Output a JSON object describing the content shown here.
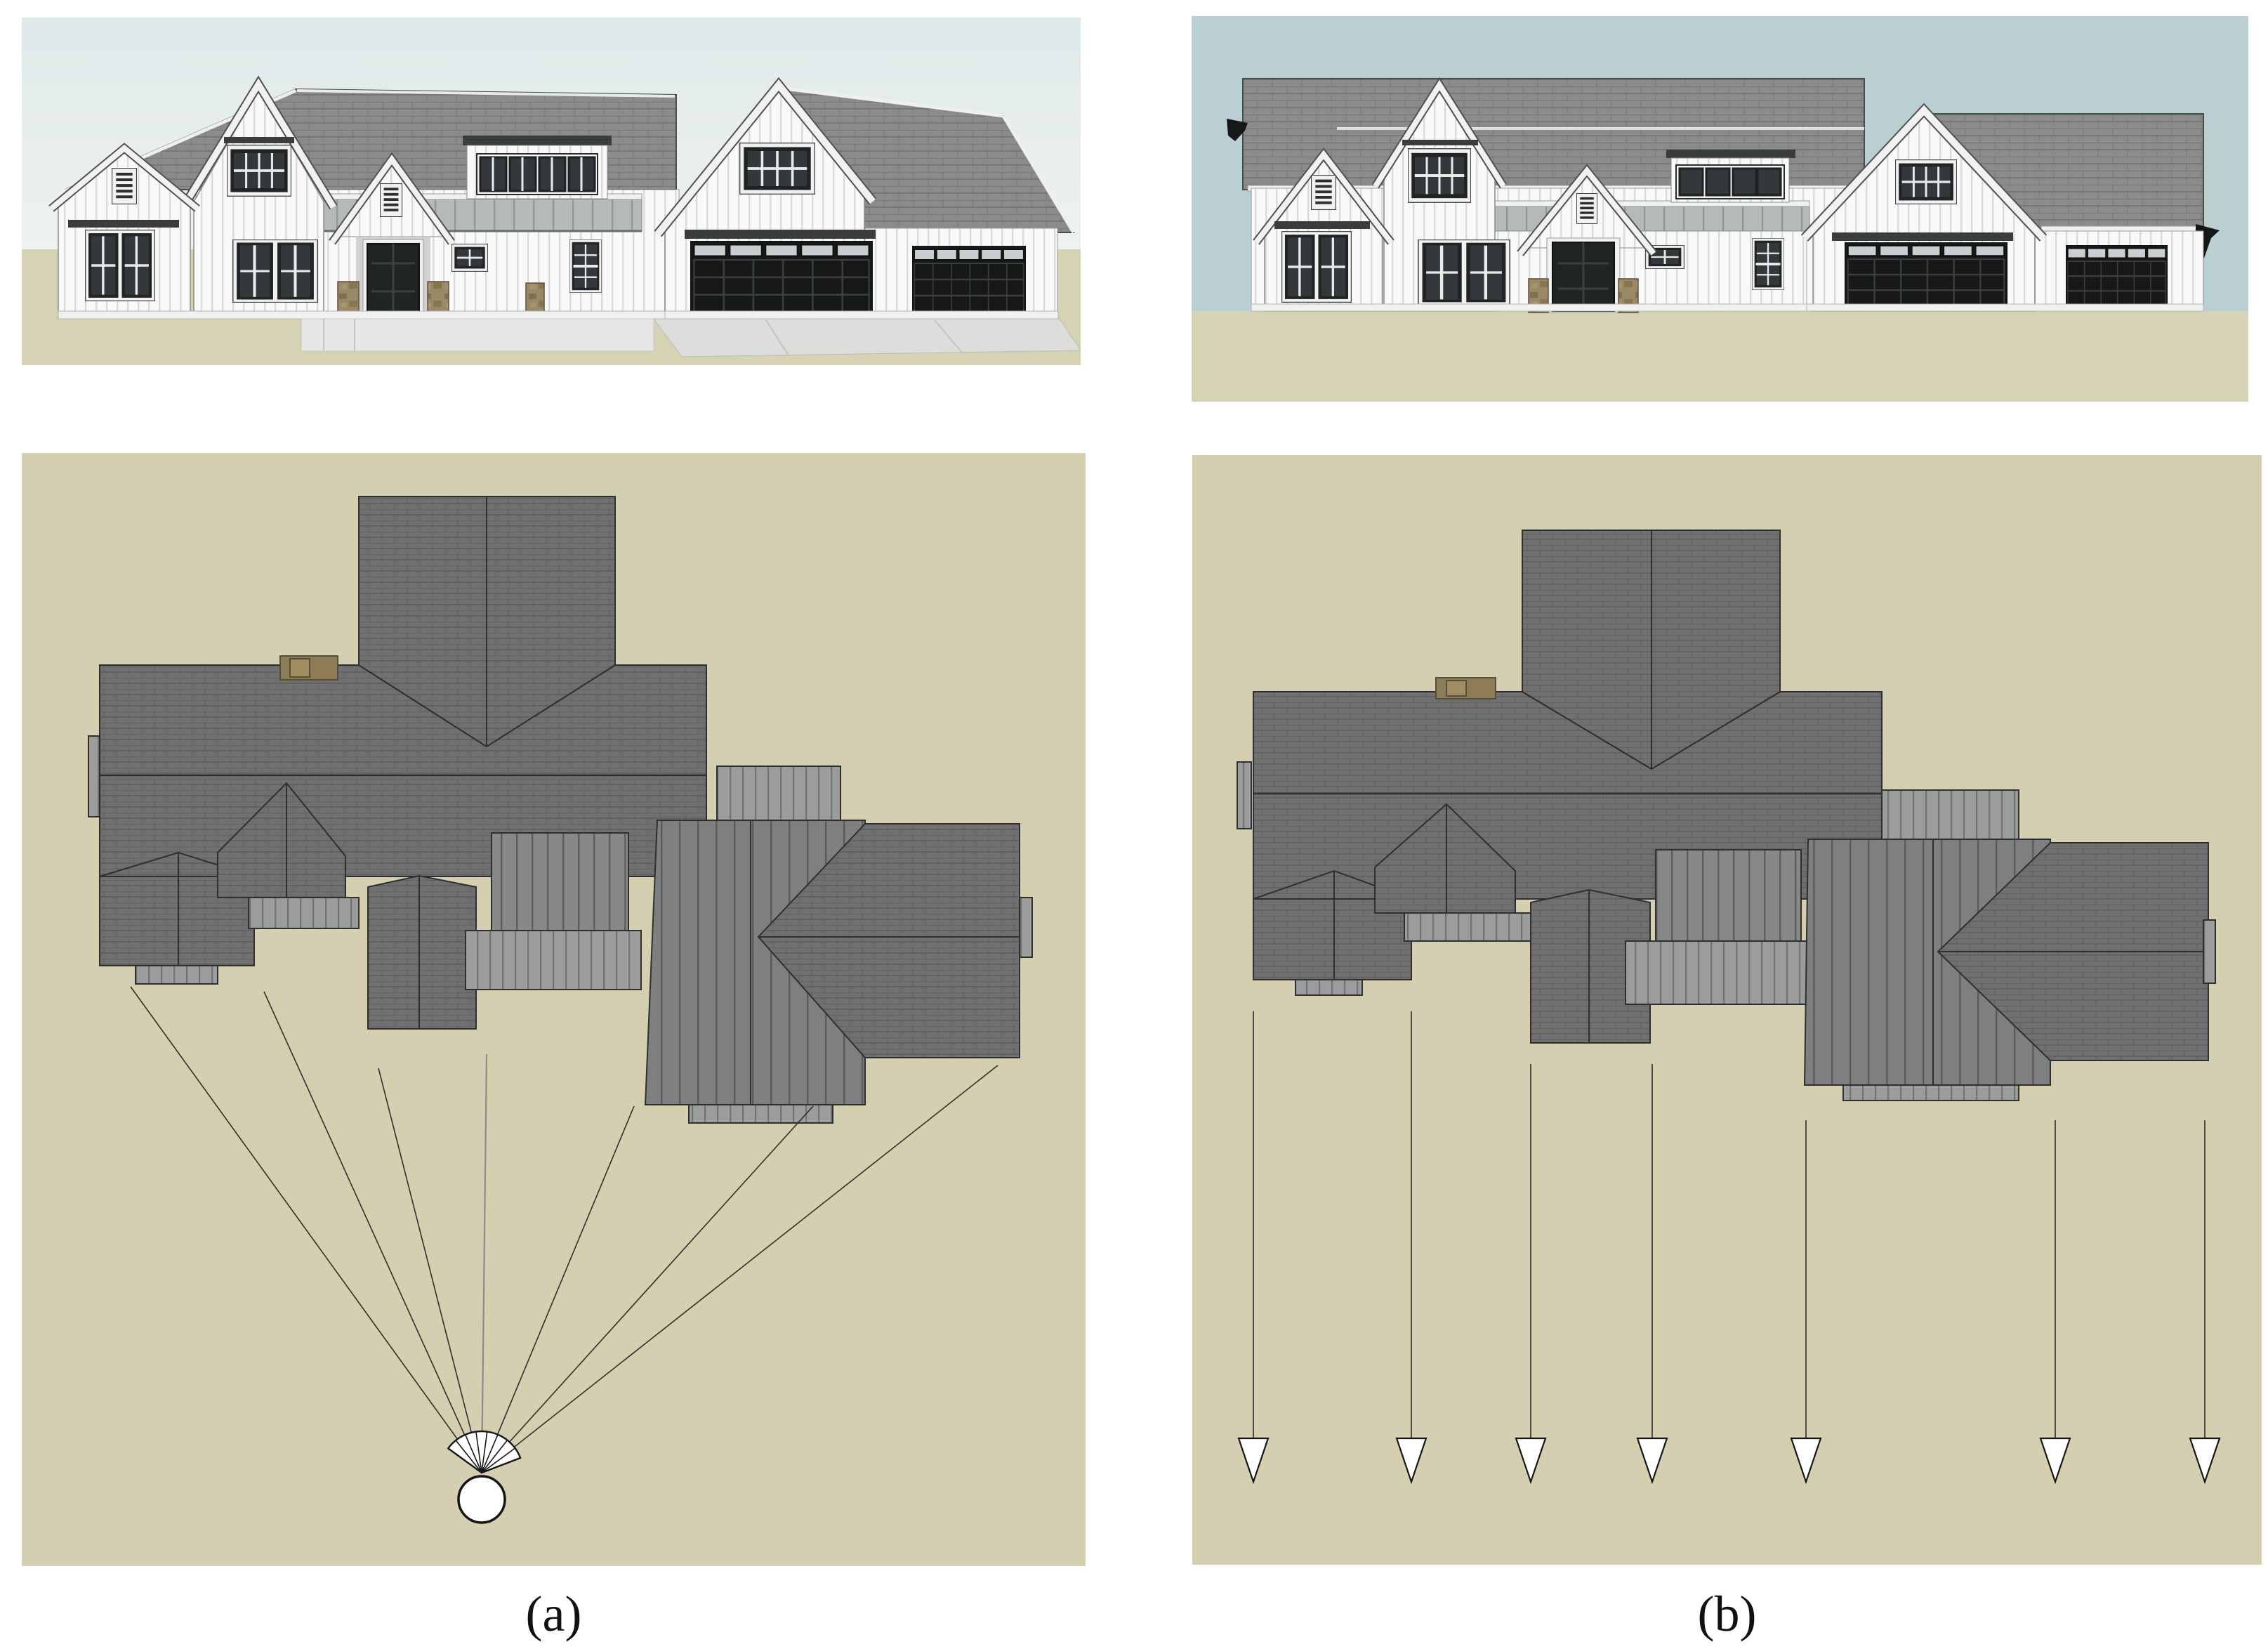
{
  "figure": {
    "columns": [
      {
        "label": "(a)",
        "projection": "perspective",
        "projection_ray_count": 7
      },
      {
        "label": "(b)",
        "projection": "orthographic",
        "projection_arrow_count": 7
      }
    ],
    "icons": [
      "camera-fan-icon",
      "camera-position-icon",
      "arrow-down-icon",
      "louver-vent-icon",
      "chimney"
    ]
  },
  "colors": {
    "page_bg": "#ffffff",
    "sky_a_top": "#dfe9e9",
    "sky_a_bottom": "#eef2f1",
    "sky_b": "#b9cfd1",
    "ground_elev": "#d6d2b4",
    "ground_plan": "#d3cfb0",
    "roof_elev": "#8b8c8a",
    "roof_plan": "#6f706f",
    "seam_light": "#9a9d9c",
    "seam_dark": "#868988",
    "seam_dark2": "#7d807f",
    "metal": "#b4b9b9",
    "wall": "#f8f9f8",
    "batten": "#d8dcdc",
    "frame_dark": "#212425",
    "glass": "#33383b",
    "garage_door": "#171919",
    "transom": "#c9ced1",
    "stone": "#9a8967",
    "chimney": "#8d7c55",
    "outline": "#2e2f2e",
    "ray": "#2f2f2f",
    "fascia": "#f0f1f0",
    "awning": "#3a3d3d"
  }
}
